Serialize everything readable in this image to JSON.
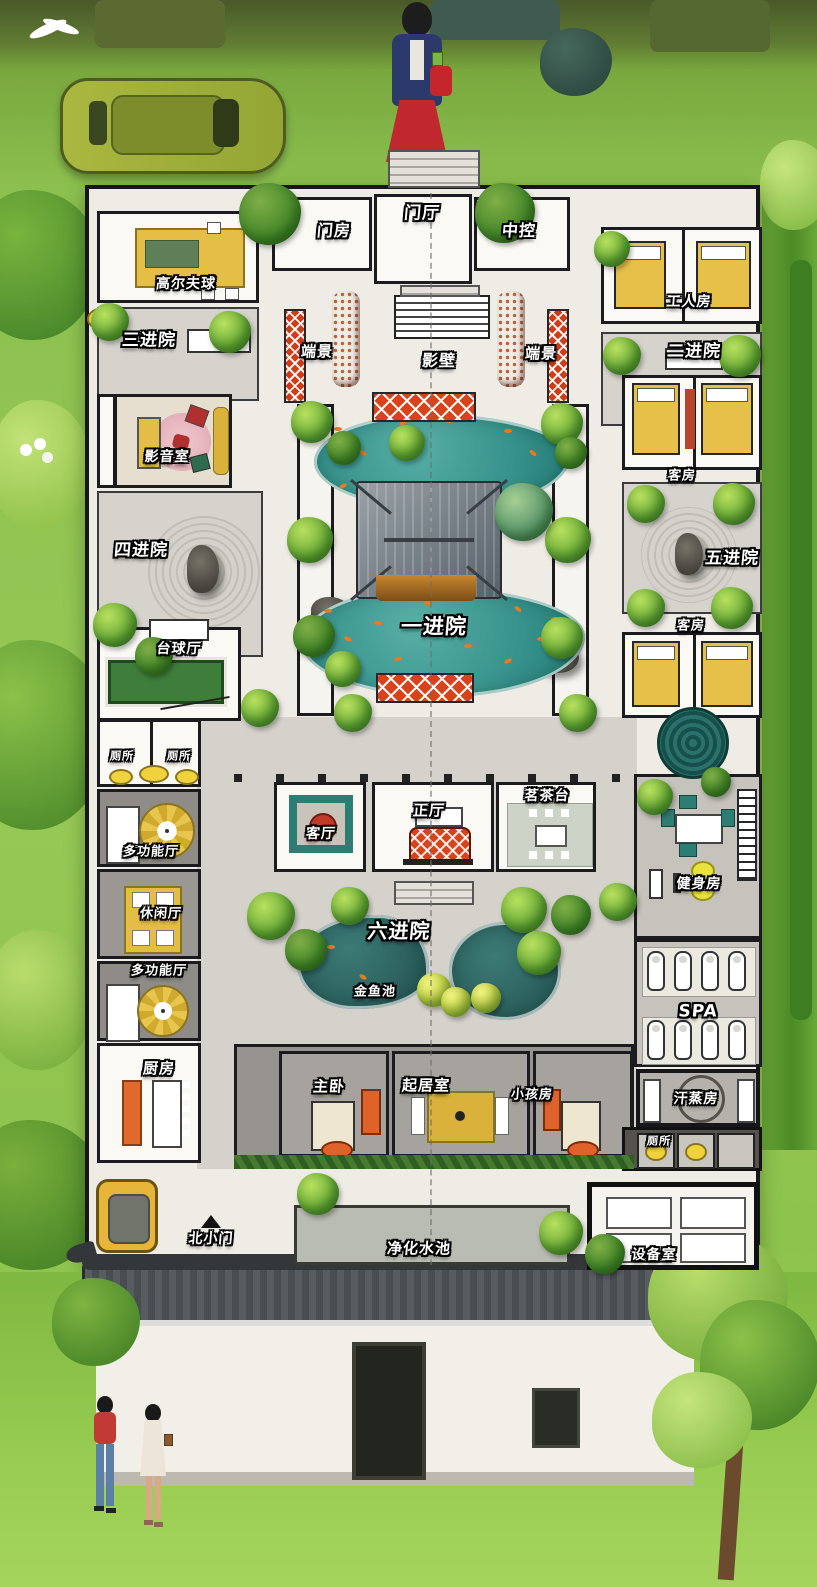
{
  "rooms": {
    "gate_room": "门房",
    "entrance_hall": "门厅",
    "control_room": "中控",
    "golf_room": "高尔夫球",
    "workers_room": "工人房",
    "courtyard_3": "三进院",
    "courtyard_2": "二进院",
    "vista_left": "端景",
    "vista_right": "端景",
    "screen_wall": "影壁",
    "av_room": "影音室",
    "guest_room_upper": "客房",
    "courtyard_4": "四进院",
    "courtyard_5": "五进院",
    "guest_room_lower": "客房",
    "billiards_hall": "台球厅",
    "courtyard_1": "一进院",
    "toilet_left_a": "厕所",
    "toilet_left_b": "厕所",
    "multi_hall_upper": "多功能厅",
    "lounge_hall": "休闲厅",
    "multi_hall_lower": "多功能厅",
    "living_room": "客厅",
    "main_hall": "正厅",
    "tea_station": "茗茶台",
    "gym": "健身房",
    "courtyard_6": "六进院",
    "goldfish_pond": "金鱼池",
    "spa": "SPA",
    "sauna": "汗蒸房",
    "kitchen": "厨房",
    "master_bedroom": "主卧",
    "sitting_room": "起居室",
    "kids_room": "小孩房",
    "north_small_gate": "北小门",
    "purification_pool": "净化水池",
    "equipment_room": "设备室"
  },
  "palette": {
    "grass_green": "#8cc04f",
    "plan_paper": "#efece6",
    "courtyard_gray": "#d6d3cd",
    "pond_teal": "#35918a",
    "pond_dark_teal": "#2c615e",
    "accent_red": "#d8431c",
    "furniture_yellow": "#e3bd45",
    "koi_orange": "#e87a22",
    "roof_gray": "#788088",
    "wall_black": "#17171b"
  }
}
